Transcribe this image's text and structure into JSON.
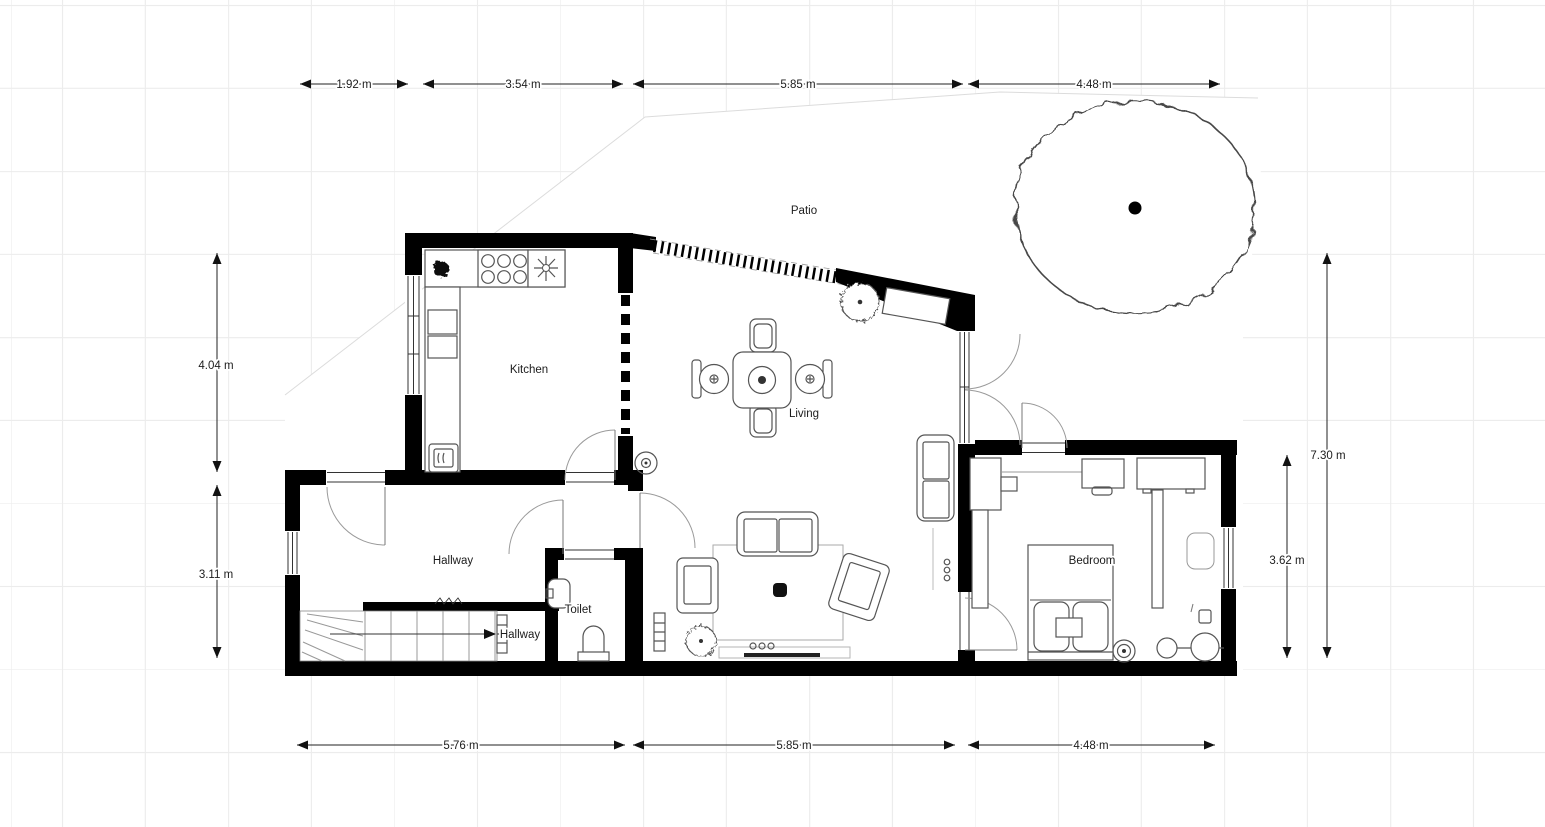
{
  "rooms": {
    "patio": "Patio",
    "kitchen": "Kitchen",
    "living": "Living",
    "hallway": "Hallway",
    "hallway_lower": "Hallway",
    "toilet": "Toilet",
    "bedroom": "Bedroom"
  },
  "dimensions": {
    "top": [
      "1.92 m",
      "3.54 m",
      "5.85 m",
      "4.48 m"
    ],
    "left": [
      "4.04 m",
      "3.11 m"
    ],
    "right": [
      "7.30 m",
      "3.62 m"
    ],
    "bottom": [
      "5.76 m",
      "5.85 m",
      "4.48 m"
    ]
  },
  "colors": {
    "wall": "#000000",
    "grid": "#ececec",
    "furniture_outline": "#555555",
    "background": "#ffffff"
  }
}
